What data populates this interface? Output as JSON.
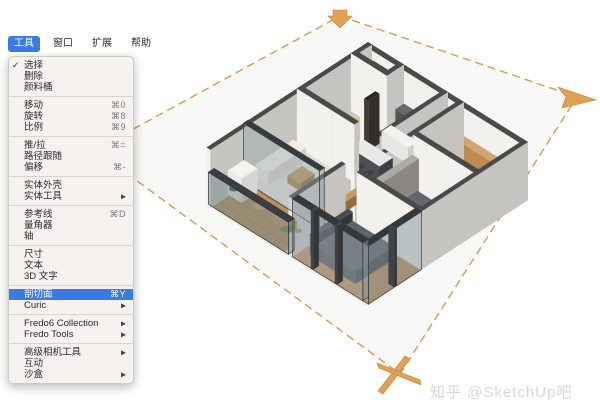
{
  "colors": {
    "highlight_blue": "#3b7be4",
    "plane_orange": "#d79a55",
    "marker_orange": "#e2a055",
    "marker_edge": "#bd8136",
    "menu_bg": "#f5f2ef",
    "watermark_gray": "#d7d7d7"
  },
  "menubar": {
    "items": [
      {
        "label": "工具",
        "active": true
      },
      {
        "label": "窗口",
        "active": false
      },
      {
        "label": "扩展",
        "active": false
      },
      {
        "label": "帮助",
        "active": false
      }
    ]
  },
  "tools_menu": {
    "items": [
      {
        "label": "选择",
        "checked": true
      },
      {
        "label": "删除"
      },
      {
        "label": "颜料桶"
      },
      {
        "sep": true
      },
      {
        "label": "移动",
        "shortcut": "⌘0"
      },
      {
        "label": "旋转",
        "shortcut": "⌘8"
      },
      {
        "label": "比例",
        "shortcut": "⌘9"
      },
      {
        "sep": true
      },
      {
        "label": "推/拉",
        "shortcut": "⌘="
      },
      {
        "label": "路径跟随"
      },
      {
        "label": "偏移",
        "shortcut": "⌘-"
      },
      {
        "sep": true
      },
      {
        "label": "实体外壳"
      },
      {
        "label": "实体工具",
        "submenu": true
      },
      {
        "sep": true
      },
      {
        "label": "参考线",
        "shortcut": "⌘D"
      },
      {
        "label": "量角器"
      },
      {
        "label": "轴"
      },
      {
        "sep": true
      },
      {
        "label": "尺寸"
      },
      {
        "label": "文本"
      },
      {
        "label": "3D 文字"
      },
      {
        "sep": true
      },
      {
        "label": "剖切面",
        "shortcut": "⌘Y",
        "highlighted": true
      },
      {
        "label": "Curic",
        "submenu": true
      },
      {
        "sep": true
      },
      {
        "label": "Fredo6 Collection",
        "submenu": true
      },
      {
        "label": "Fredo Tools",
        "submenu": true
      },
      {
        "sep": true
      },
      {
        "label": "高级相机工具",
        "submenu": true
      },
      {
        "label": "互动"
      },
      {
        "label": "沙盒",
        "submenu": true
      }
    ]
  },
  "watermark": {
    "text": "知乎 @SketchUp吧"
  },
  "section_plane": {
    "outline": [
      [
        340,
        16
      ],
      [
        577,
        97
      ],
      [
        400,
        374
      ],
      [
        95,
        150
      ]
    ],
    "fill": "#f8f8f6",
    "dash_color": "#d79a55",
    "markers": [
      {
        "name": "top-arrow-marker",
        "pts": [
          [
            333,
            10
          ],
          [
            347,
            10
          ],
          [
            347,
            16
          ],
          [
            352,
            16
          ],
          [
            340,
            28
          ],
          [
            328,
            16
          ],
          [
            333,
            16
          ]
        ]
      },
      {
        "name": "right-fold-marker",
        "pts": [
          [
            558,
            87
          ],
          [
            596,
            100
          ],
          [
            562,
            108
          ],
          [
            566,
            97
          ]
        ]
      },
      {
        "name": "bottom-star-marker",
        "pts": [
          [
            405,
            356
          ],
          [
            410,
            359
          ],
          [
            383,
            394
          ],
          [
            378,
            391
          ]
        ]
      },
      {
        "name": "bottom-star-marker-2",
        "pts": [
          [
            377,
            363
          ],
          [
            379,
            368
          ],
          [
            421,
            385
          ],
          [
            420,
            380
          ]
        ]
      }
    ]
  },
  "scene": {
    "proj": {
      "o": [
        368,
        100
      ],
      "u": [
        0.8,
        0.5
      ],
      "v": [
        -0.95,
        0.62
      ]
    },
    "shapes": [
      {
        "t": "f",
        "r": [
          0,
          0,
          200,
          170
        ],
        "f": "#eae8e5"
      },
      {
        "t": "f",
        "r": [
          45,
          0,
          95,
          42
        ],
        "f": "#c9c7c3"
      },
      {
        "t": "f",
        "r": [
          0,
          0,
          45,
          18
        ],
        "f": "#dbd9d5"
      },
      {
        "t": "f",
        "r": [
          0,
          18,
          45,
          75
        ],
        "f": "#dcc69e"
      },
      {
        "t": "f",
        "r": [
          120,
          0,
          200,
          52
        ],
        "f": "#cfa674"
      },
      {
        "t": "f",
        "r": [
          45,
          42,
          95,
          75
        ],
        "f": "#d5d3cf"
      },
      {
        "t": "f",
        "r": [
          95,
          0,
          120,
          115
        ],
        "f": "#d8d6d2"
      },
      {
        "t": "f",
        "r": [
          120,
          52,
          200,
          112
        ],
        "f": "#c69a62"
      },
      {
        "t": "f",
        "r": [
          0,
          75,
          95,
          130
        ],
        "f": "#e0ded9"
      },
      {
        "t": "f",
        "r": [
          100,
          112,
          200,
          168
        ],
        "f": "#bf9156"
      },
      {
        "t": "f",
        "r": [
          0,
          130,
          95,
          168
        ],
        "f": "#bb915b"
      },
      {
        "t": "l",
        "a": [
          0,
          140
        ],
        "b": [
          95,
          140
        ],
        "h": 0,
        "st": "#a37c48"
      },
      {
        "t": "l",
        "a": [
          0,
          150
        ],
        "b": [
          95,
          150
        ],
        "h": 0,
        "st": "#a37c48"
      },
      {
        "t": "l",
        "a": [
          0,
          160
        ],
        "b": [
          95,
          160
        ],
        "h": 0,
        "st": "#a37c48"
      },
      {
        "t": "l",
        "a": [
          130,
          52
        ],
        "b": [
          130,
          112
        ],
        "h": 0,
        "st": "#b3874f"
      },
      {
        "t": "l",
        "a": [
          150,
          52
        ],
        "b": [
          150,
          112
        ],
        "h": 0,
        "st": "#b3874f"
      },
      {
        "t": "l",
        "a": [
          170,
          52
        ],
        "b": [
          170,
          112
        ],
        "h": 0,
        "st": "#b3874f"
      },
      {
        "t": "p",
        "r": [
          0,
          0,
          200,
          5
        ],
        "h": 58
      },
      {
        "t": "p",
        "r": [
          8,
          1,
          40,
          14
        ],
        "h": 44,
        "s": "#c59a63",
        "sd": "#a87f4e",
        "tp": "#555351"
      },
      {
        "t": "p",
        "r": [
          0,
          0,
          5,
          170
        ],
        "h": 58
      },
      {
        "t": "p",
        "r": [
          40,
          0,
          45,
          42
        ],
        "h": 58
      },
      {
        "t": "p",
        "r": [
          46,
          1,
          94,
          10
        ],
        "h": 20,
        "s": "#57575a",
        "sd": "#47474a",
        "tp": "#68686b"
      },
      {
        "t": "d",
        "c": [
          70,
          7
        ],
        "h": 22,
        "r": 4,
        "f": "#b23830"
      },
      {
        "t": "p",
        "r": [
          0,
          13,
          45,
          18
        ],
        "h": 58
      },
      {
        "t": "p",
        "r": [
          125,
          5,
          195,
          12
        ],
        "h": 30,
        "s": "#c08b4e",
        "sd": "#9e6f3c",
        "tp": "#cfa672"
      },
      {
        "t": "p",
        "r": [
          95,
          0,
          100,
          115
        ],
        "h": 58
      },
      {
        "t": "p",
        "r": [
          115,
          0,
          120,
          115
        ],
        "h": 58
      },
      {
        "t": "p",
        "r": [
          55,
          22,
          88,
          32
        ],
        "h": 16,
        "s": "#e9e7e3",
        "sd": "#cfcdc9",
        "tp": "#f3f2ef"
      },
      {
        "t": "p",
        "r": [
          45,
          30,
          50,
          42
        ],
        "h": 50,
        "s": "#423c37",
        "sd": "#332e2a",
        "tp": "#2b2724"
      },
      {
        "t": "p",
        "r": [
          0,
          70,
          45,
          75
        ],
        "h": 58
      },
      {
        "t": "p",
        "r": [
          52,
          48,
          88,
          62
        ],
        "h": 16,
        "s": "#4f4f53",
        "sd": "#3f3f43",
        "tp": "#eae9e7"
      },
      {
        "t": "d",
        "c": [
          58,
          67
        ],
        "h": 10,
        "r": 4,
        "f": "#3d4045"
      },
      {
        "t": "d",
        "c": [
          70,
          67
        ],
        "h": 10,
        "r": 4,
        "f": "#3d4045"
      },
      {
        "t": "d",
        "c": [
          82,
          67
        ],
        "h": 10,
        "r": 4,
        "f": "#3d4045"
      },
      {
        "t": "p",
        "r": [
          120,
          48,
          200,
          53
        ],
        "h": 58
      },
      {
        "t": "p",
        "r": [
          121,
          55,
          129,
          105
        ],
        "h": 40,
        "s": "#9d9a96",
        "sd": "#8a8783",
        "tp": "#acaaa6"
      },
      {
        "t": "p",
        "r": [
          133,
          60,
          187,
          100
        ],
        "h": 13,
        "s": "#55585d",
        "sd": "#45484d",
        "tp": "#63666c"
      },
      {
        "t": "d",
        "c": [
          180,
          70
        ],
        "h": 15,
        "r": 5,
        "f": "#e8e7e4"
      },
      {
        "t": "p",
        "r": [
          45,
          70,
          72,
          75
        ],
        "h": 58
      },
      {
        "t": "p",
        "r": [
          4,
          82,
          20,
          122
        ],
        "h": 13,
        "s": "#e9e4da",
        "sd": "#d4cfc4",
        "tp": "#f1ede4"
      },
      {
        "t": "p",
        "r": [
          30,
          95,
          46,
          110
        ],
        "h": 8,
        "s": "#aa8049",
        "sd": "#8f6a3b",
        "tp": "#bc9359"
      },
      {
        "t": "p",
        "r": [
          88,
          78,
          95,
          125
        ],
        "h": 10,
        "s": "#b08850",
        "sd": "#936f40",
        "tp": "#c19a60"
      },
      {
        "t": "p",
        "r": [
          120,
          108,
          200,
          113
        ],
        "h": 58
      },
      {
        "t": "p",
        "r": [
          100,
          112,
          105,
          168
        ],
        "h": 58
      },
      {
        "t": "p",
        "r": [
          115,
          118,
          121,
          158
        ],
        "h": 22,
        "s": "#3f4145",
        "sd": "#333539",
        "tp": "#4a4c50"
      },
      {
        "t": "p",
        "r": [
          121,
          118,
          172,
          158
        ],
        "h": 13,
        "s": "#54565a",
        "sd": "#44464a",
        "tp": "#606368"
      },
      {
        "t": "p",
        "r": [
          195,
          0,
          200,
          112
        ],
        "h": 58
      },
      {
        "t": "p",
        "r": [
          193,
          112,
          200,
          168
        ],
        "h": 58,
        "s": "rgba(150,165,172,0.45)",
        "sd": "rgba(130,145,152,0.5)",
        "tp": "#34383b",
        "st": "#3a3e41"
      },
      {
        "t": "p",
        "r": [
          193,
          138,
          200,
          141
        ],
        "h": 58,
        "s": "#3f4246",
        "sd": "#34373a",
        "tp": "#3f4246"
      },
      {
        "t": "p",
        "r": [
          0,
          126,
          95,
          131
        ],
        "h": 58,
        "s": "rgba(150,165,172,0.4)",
        "sd": "rgba(130,145,152,0.45)",
        "tp": "#383b3e",
        "st": "#3a3e41"
      },
      {
        "t": "p",
        "r": [
          3,
          133,
          20,
          150
        ],
        "h": 24,
        "s": "#edebe7",
        "sd": "#d8d6d2",
        "tp": "#f4f3f0"
      },
      {
        "t": "d",
        "c": [
          13,
          152
        ],
        "h": 12,
        "r": 5,
        "f": "#44464a"
      },
      {
        "t": "d",
        "c": [
          45,
          150
        ],
        "h": 10,
        "r": 8,
        "f": "#d4a966"
      },
      {
        "t": "p",
        "r": [
          58,
          142,
          80,
          150
        ],
        "h": 8,
        "s": "#c19a5c",
        "sd": "#a5813f",
        "tp": "#cfaa6a"
      },
      {
        "t": "d",
        "c": [
          88,
          160
        ],
        "h": 14,
        "r": 6,
        "f": "#6d8f54"
      },
      {
        "t": "d",
        "c": [
          92,
          151
        ],
        "h": 9,
        "r": 4,
        "f": "#7da05e"
      },
      {
        "t": "p",
        "r": [
          105,
          162,
          193,
          168
        ],
        "h": 58,
        "s": "rgba(150,165,172,0.45)",
        "sd": "rgba(130,145,152,0.5)",
        "tp": "#34383b",
        "st": "#3a3e41"
      },
      {
        "t": "p",
        "r": [
          128,
          162,
          131,
          168
        ],
        "h": 58,
        "s": "#3f4246",
        "sd": "#34373a",
        "tp": "#3f4246"
      },
      {
        "t": "p",
        "r": [
          158,
          162,
          161,
          168
        ],
        "h": 58,
        "s": "#3f4246",
        "sd": "#34373a",
        "tp": "#3f4246"
      },
      {
        "t": "p",
        "r": [
          0,
          162,
          100,
          168
        ],
        "h": 32,
        "s": "rgba(120,135,140,0.5)",
        "sd": "rgba(100,115,120,0.55)",
        "tp": "#3a3e42",
        "st": "#33373a"
      }
    ],
    "defaults": {
      "side": "#f2f1ee",
      "side_dark": "#c6c4c0",
      "top": "#4a4a4a"
    }
  }
}
